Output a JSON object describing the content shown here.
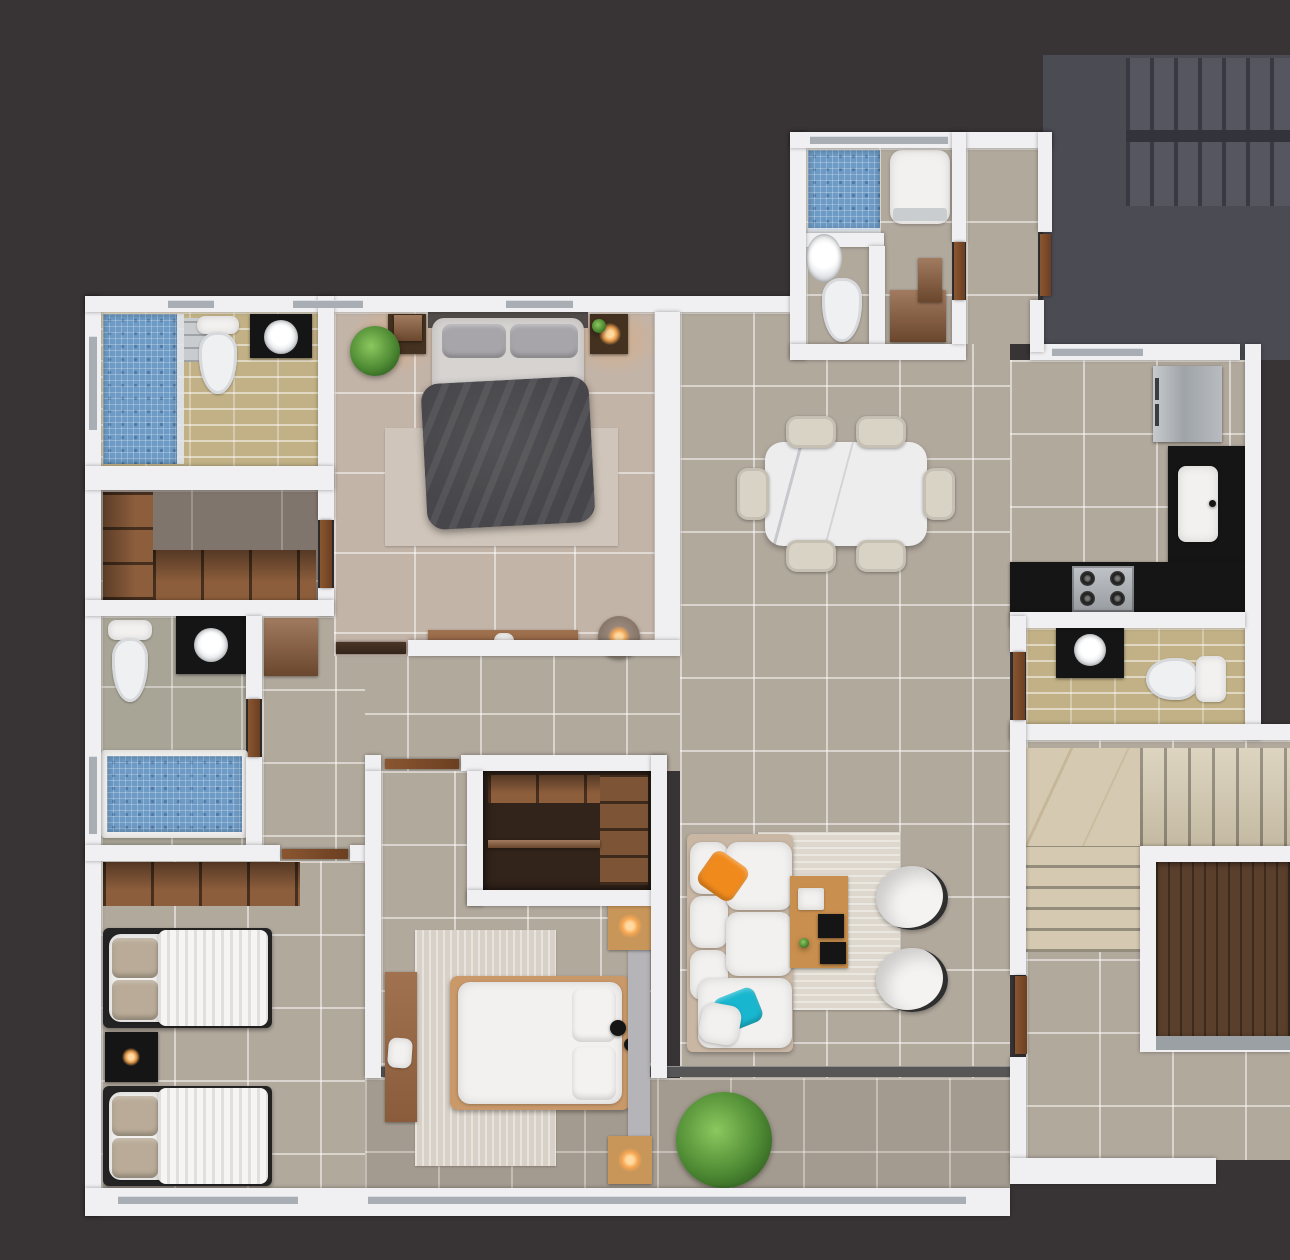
{
  "scene": {
    "type": "3d-floor-plan-top-down-render",
    "description": "Photorealistic top-down 3D render of an apartment floor plan with furnished rooms on a dark charcoal background",
    "visible_text": null
  },
  "palette": {
    "bg": "#383435",
    "wall": "#f0f0f3",
    "glass": "#a8aeb4",
    "floor_main": "#b2a99d",
    "floor_master": "#c3b4a8",
    "floor_dark": "#80756c",
    "floor_balcony": "#a49b90",
    "grout": "rgba(255,255,255,0.5)",
    "blue_mosaic": "#6d9bc6",
    "tan_tile": "#c2b186",
    "wood": "#a1724f",
    "wood_mid": "#8d5e3c",
    "wood_dark": "#5a3f2c",
    "black_fixture": "#151515",
    "white_furniture": "#f2f1ef",
    "sofa_base": "#c9b7a4",
    "accent_orange": "#f08a1d",
    "accent_cyan": "#18b7cf",
    "plant_green": "#4e8a33",
    "lamp_glow": "#ffb45e",
    "marble": "#ededee",
    "core_gray": "#4b4b53",
    "stair_marble": "#d5cab1",
    "rug": "#d8d1c8",
    "duvet_dark": "#47464a",
    "headboard_gray": "#514c4a"
  },
  "rooms": [
    {
      "id": "master-bedroom",
      "label": "Master Bedroom",
      "furniture": [
        "double-bed-dark-duvet",
        "gray-pillows",
        "area-rug",
        "nightstand-left-with-plant",
        "nightstand-right-with-lamp",
        "potted-plant",
        "low-dresser",
        "round-pouf-lamp",
        "sliding-door"
      ]
    },
    {
      "id": "ensuite-bathroom",
      "label": "Ensuite Bathroom",
      "furniture": [
        "blue-mosaic-shower",
        "toilet",
        "black-vanity-with-sink",
        "glass-shelf"
      ]
    },
    {
      "id": "walk-in-closet",
      "label": "Walk-in Closet",
      "furniture": [
        "open-shelving-left",
        "open-shelving-bottom"
      ]
    },
    {
      "id": "guest-bathroom",
      "label": "Guest Bathroom",
      "furniture": [
        "toilet",
        "black-vanity-with-round-sink",
        "blue-mosaic-bathtub",
        "door"
      ]
    },
    {
      "id": "hall-closet",
      "label": "Hallway",
      "furniture": [
        "wall-cabinet"
      ]
    },
    {
      "id": "twin-bedroom",
      "label": "Twin Bedroom",
      "furniture": [
        "single-bed-1",
        "single-bed-2",
        "black-nightstand-with-lamp",
        "open-shelf-row",
        "window"
      ]
    },
    {
      "id": "second-bedroom",
      "label": "Second Bedroom",
      "furniture": [
        "double-bed-white",
        "wood-bed-frame",
        "gray-headboard-panel",
        "wardrobe-with-cubbies",
        "desk-with-laptop",
        "rug",
        "nightstand-lamps"
      ]
    },
    {
      "id": "living-room",
      "label": "Living Room",
      "furniture": [
        "white-corner-sofa",
        "orange-pillow",
        "cyan-pillow",
        "striped-rug",
        "wood-coffee-table-with-decor",
        "two-white-armchairs",
        "green-plant"
      ]
    },
    {
      "id": "dining-area",
      "label": "Dining Area",
      "furniture": [
        "marble-dining-table",
        "six-cream-chairs"
      ]
    },
    {
      "id": "kitchen",
      "label": "Kitchen",
      "furniture": [
        "stainless-fridge",
        "black-counter-with-sink",
        "black-counter-with-gas-hob"
      ]
    },
    {
      "id": "laundry-bathroom",
      "label": "Laundry Bathroom",
      "furniture": [
        "blue-mosaic-shower",
        "washing-machine",
        "wall-mounted-sink",
        "toilet",
        "wood-cabinet"
      ]
    },
    {
      "id": "common-bathroom",
      "label": "Common Bathroom",
      "furniture": [
        "black-vanity-with-round-sink",
        "toilet",
        "door"
      ]
    },
    {
      "id": "stair-hall",
      "label": "Stair Hall",
      "furniture": [
        "marble-landing",
        "marble-stair-flights",
        "elevator-with-wood-cab"
      ]
    },
    {
      "id": "stairwell-core",
      "label": "Common Stairwell Core",
      "furniture": [
        "concrete-stair-flights"
      ]
    },
    {
      "id": "balcony",
      "label": "Balcony",
      "furniture": [
        "sliding-track"
      ]
    }
  ]
}
